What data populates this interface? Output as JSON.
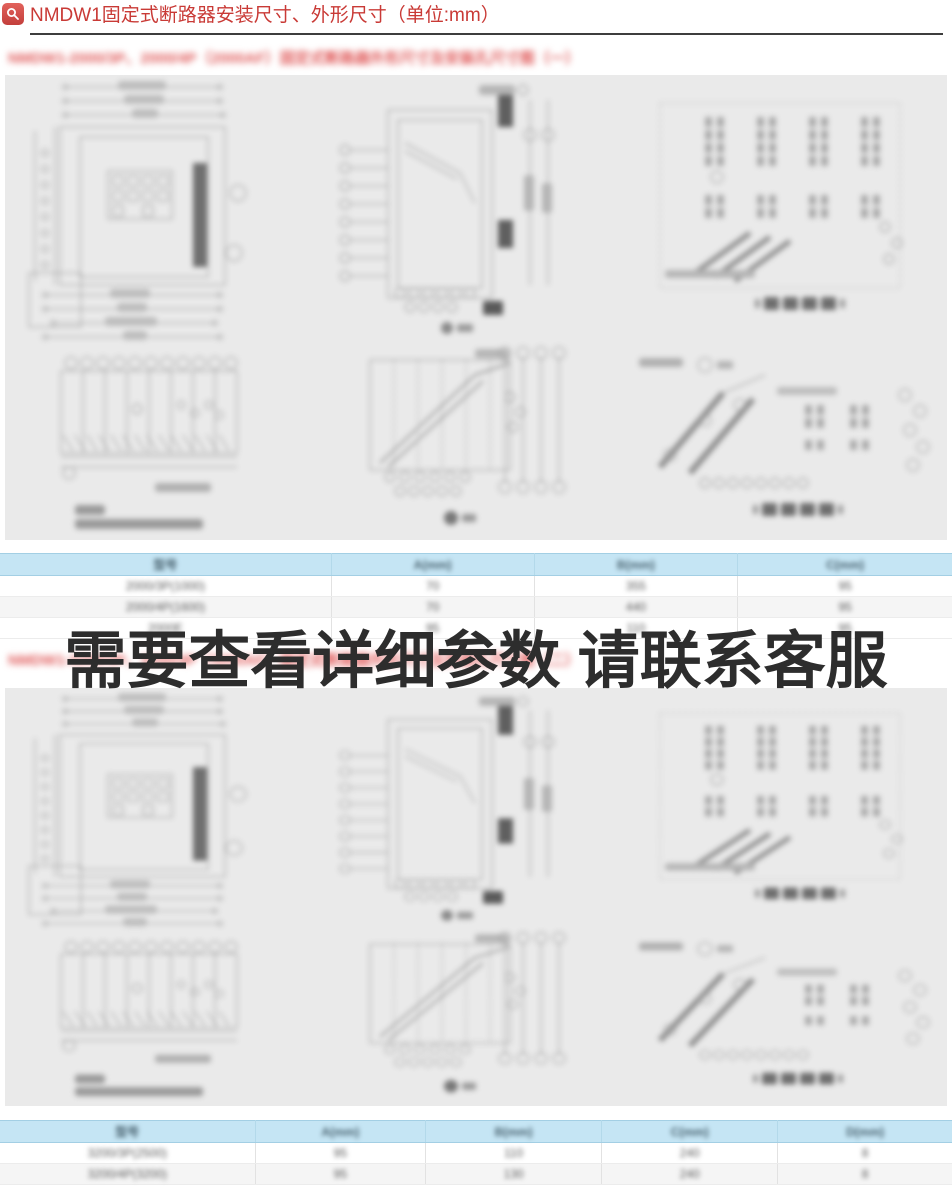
{
  "header": {
    "icon": "magnifier-icon",
    "title": "NMDW1固定式断路器安装尺寸、外形尺寸（单位:mm）",
    "accent_color": "#c93a36"
  },
  "overlay": {
    "text": "需要查看详细参数 请联系客服"
  },
  "section1": {
    "subtitle": "NMDW1-2000/3P、2000/4P（2000AF）固定式断路器外形尺寸及安装孔尺寸图（一）",
    "table": {
      "headers": [
        "型号",
        "A(mm)",
        "B(mm)",
        "C(mm)"
      ],
      "rows": [
        [
          "2000/3P(1000)",
          "70",
          "355",
          "95"
        ],
        [
          "2000/4P(1600)",
          "70",
          "440",
          "95"
        ],
        [
          "2000E",
          "95",
          "110",
          "95"
        ]
      ]
    }
  },
  "section2": {
    "subtitle": "NMDW1-3200/3P、3200/4P（3200AF）固定式断路器外形尺寸及安装孔尺寸图（二）",
    "table": {
      "headers": [
        "型号",
        "A(mm)",
        "B(mm)",
        "C(mm)",
        "D(mm)"
      ],
      "rows": [
        [
          "3200/3P(2500)",
          "95",
          "110",
          "240",
          "8"
        ],
        [
          "3200/4P(3200)",
          "95",
          "130",
          "240",
          "8"
        ]
      ]
    }
  },
  "colors": {
    "title_red": "#c93a36",
    "subtitle_red": "#e05c5c",
    "panel_gray": "#eaeaea",
    "table_header_blue": "#c5e5f4",
    "overlay_text": "#2d2d2d"
  }
}
